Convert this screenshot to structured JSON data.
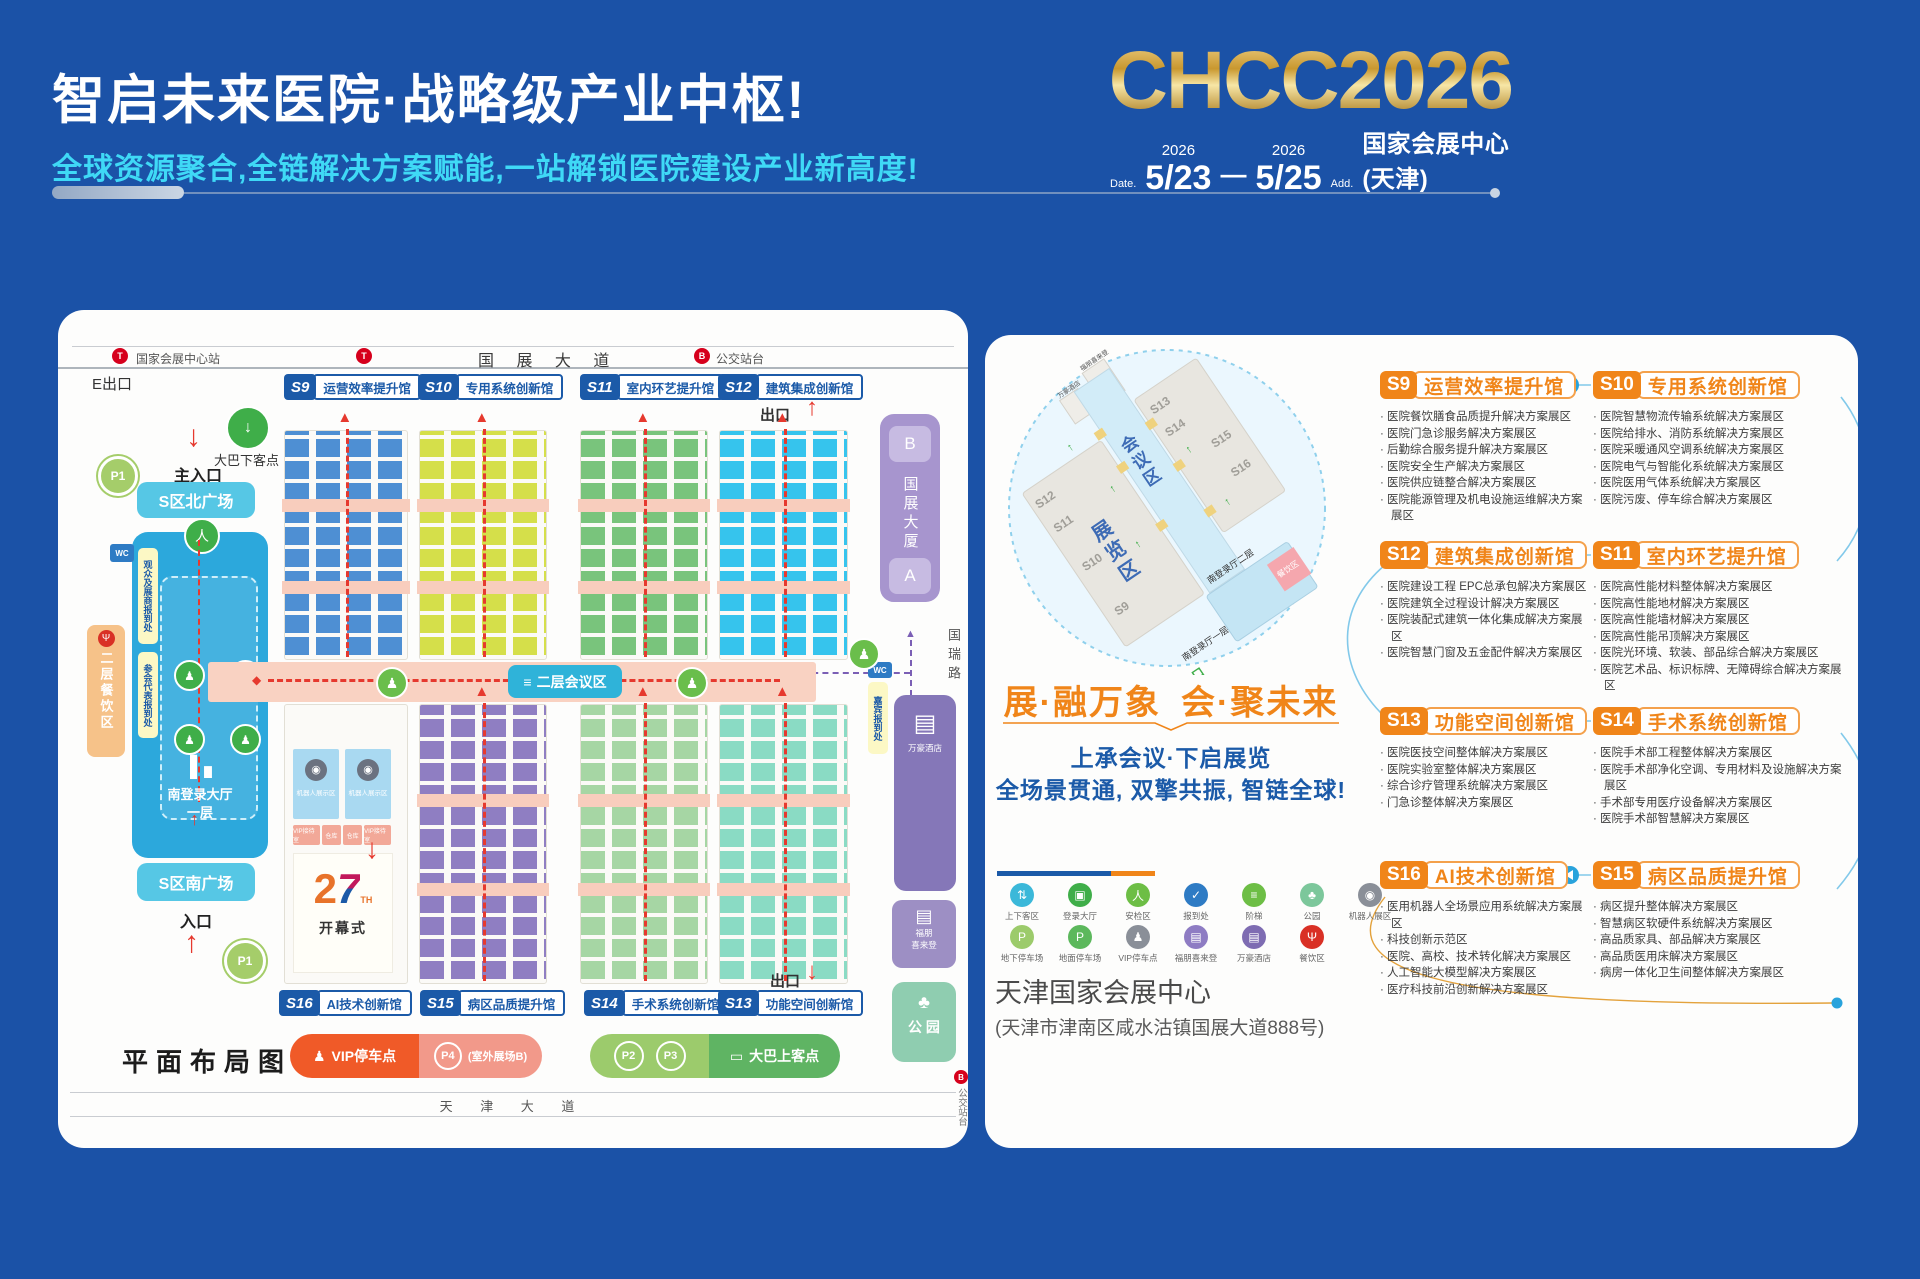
{
  "theme": {
    "page_bg": "#1B52A7",
    "orange": "#F08519",
    "blue": "#1B5AA8",
    "cyan": "#3FD9F6",
    "red": "#E6392E",
    "salmon": "#F8CDBD",
    "gold": "#D9A93C",
    "connector_blue": "#29A3DC"
  },
  "header": {
    "title": "智启未来医院·战略级产业中枢!",
    "subtitle": "全球资源聚合,全链解决方案赋能,一站解锁医院建设产业新高度!",
    "logo": "CHCC2026",
    "date_label": "Date.",
    "year_start": "2026",
    "date_start": "5/23",
    "dash": "—",
    "year_end": "2026",
    "date_end": "5/25",
    "addr_label": "Add.",
    "venue": "国家会展中心(天津)"
  },
  "map": {
    "top_road": {
      "station": "国家会展中心站",
      "bus": "公交站台",
      "name": "国 展 大 道",
      "exit_e": "E出口",
      "exit_f": "F出口",
      "exit_top": "出口"
    },
    "halls_top": [
      {
        "code": "S9",
        "name": "运营效率提升馆",
        "color": "#4E8FD3"
      },
      {
        "code": "S10",
        "name": "专用系统创新馆",
        "color": "#D5DF4A"
      },
      {
        "code": "S11",
        "name": "室内环艺提升馆",
        "color": "#79C47C"
      },
      {
        "code": "S12",
        "name": "建筑集成创新馆",
        "color": "#36C4ED"
      }
    ],
    "halls_bottom": [
      {
        "code": "S16",
        "name": "AI技术创新馆",
        "color": "#A9D9F1"
      },
      {
        "code": "S15",
        "name": "病区品质提升馆",
        "color": "#8F7EC2"
      },
      {
        "code": "S14",
        "name": "手术系统创新馆",
        "color": "#A6D6A4"
      },
      {
        "code": "S13",
        "name": "功能空间创新馆",
        "color": "#8ADBC4"
      }
    ],
    "left": {
      "p1": "P1",
      "bus_drop": "大巴下客点",
      "main_entrance": "主入口",
      "north_plaza": "S区北广场",
      "reg_visitor": "观众及展商报到处",
      "reg_delegate": "参会代表报到处",
      "wc": "WC",
      "dining": "二层餐饮区",
      "hall_line1": "南登录大厅",
      "hall_line2": "一层",
      "south_plaza": "S区南广场",
      "entrance": "入口",
      "p1b": "P1"
    },
    "center": {
      "conference": "二层会议区",
      "robot_zone": "机器人展示区",
      "vip_room": "VIP接待室",
      "storage": "仓库",
      "opening_num2": "2",
      "opening_num7": "7",
      "opening_th": "TH",
      "opening": "开幕式"
    },
    "right": {
      "tower_b": "B",
      "tower": "国展大厦",
      "tower_a": "A",
      "road": "国瑞路",
      "guest_reg": "嘉宾报到处",
      "hotel_marriott": "万豪酒店",
      "hotel_fp1": "福朋",
      "hotel_fp2": "喜来登",
      "park": "公 园",
      "exit_bottom": "出口",
      "bus_stop": "公交站台"
    },
    "bottom": {
      "vip_parking": "VIP停车点",
      "p4": "P4",
      "p4_note": "(室外展场B)",
      "p2": "P2",
      "p3": "P3",
      "bus_pickup": "大巴上客点",
      "plan_label": "平面布局图",
      "road_name": "天 津 大 道"
    }
  },
  "panel": {
    "circle": {
      "expo": "展览区",
      "conf": "会议区",
      "main_entrance": "主入口",
      "south_l2": "南登录厅二层",
      "south_l1": "南登录厅一层",
      "dining": "餐饮区",
      "hotel1": "万豪酒店",
      "hotel2": "福朋喜来登",
      "halls_left": [
        "S12",
        "S11",
        "S10",
        "S9"
      ],
      "halls_right": [
        "S13",
        "S14",
        "S15",
        "S16"
      ]
    },
    "slogan_left": "展·融万象",
    "slogan_right": "会·聚未来",
    "sub1": "上承会议·下启展览",
    "sub2": "全场景贯通, 双擎共振, 智链全球!",
    "legend_row1": [
      {
        "label": "上下客区",
        "color": "#3BB8D9",
        "glyph": "⇅",
        "name": "shuttle-zone-icon"
      },
      {
        "label": "登录大厅",
        "color": "#3FAE49",
        "glyph": "▣",
        "name": "login-hall-icon"
      },
      {
        "label": "安检区",
        "color": "#6DBE45",
        "glyph": "人",
        "name": "security-check-icon"
      },
      {
        "label": "报到处",
        "color": "#2E7BC4",
        "glyph": "✓",
        "name": "registration-icon"
      },
      {
        "label": "阶梯",
        "color": "#6DBE45",
        "glyph": "≡",
        "name": "stairs-icon"
      },
      {
        "label": "公园",
        "color": "#7CC79B",
        "glyph": "♣",
        "name": "park-icon"
      },
      {
        "label": "机器人展区",
        "color": "#8A8F98",
        "glyph": "◉",
        "name": "robot-zone-icon"
      }
    ],
    "legend_row2": [
      {
        "label": "地下停车场",
        "color": "#9CCB6B",
        "glyph": "P",
        "name": "underground-parking-icon"
      },
      {
        "label": "地面停车场",
        "color": "#5CB85C",
        "glyph": "P",
        "name": "ground-parking-icon"
      },
      {
        "label": "VIP停车点",
        "color": "#8A8F98",
        "glyph": "♟",
        "name": "vip-parking-icon"
      },
      {
        "label": "福朋喜来登",
        "color": "#8E7CC3",
        "glyph": "▤",
        "name": "fourpoints-hotel-icon"
      },
      {
        "label": "万豪酒店",
        "color": "#7E6CB2",
        "glyph": "▤",
        "name": "marriott-hotel-icon"
      },
      {
        "label": "餐饮区",
        "color": "#D93025",
        "glyph": "Ψ",
        "name": "dining-icon"
      }
    ],
    "venue": "天津国家会展中心",
    "venue_addr": "(天津市津南区咸水沽镇国展大道888号)"
  },
  "sections": [
    {
      "code": "S9",
      "name": "运营效率提升馆",
      "items": [
        "医院餐饮膳食品质提升解决方案展区",
        "医院门急诊服务解决方案展区",
        "后勤综合服务提升解决方案展区",
        "医院安全生产解决方案展区",
        "医院供应链整合解决方案展区",
        "医院能源管理及机电设施运维解决方案展区"
      ]
    },
    {
      "code": "S10",
      "name": "专用系统创新馆",
      "items": [
        "医院智慧物流传输系统解决方案展区",
        "医院给排水、消防系统解决方案展区",
        "医院采暖通风空调系统解决方案展区",
        "医院电气与智能化系统解决方案展区",
        "医院医用气体系统解决方案展区",
        "医院污废、停车综合解决方案展区"
      ]
    },
    {
      "code": "S12",
      "name": "建筑集成创新馆",
      "items": [
        "医院建设工程 EPC总承包解决方案展区",
        "医院建筑全过程设计解决方案展区",
        "医院装配式建筑一体化集成解决方案展区",
        "医院智慧门窗及五金配件解决方案展区"
      ]
    },
    {
      "code": "S11",
      "name": "室内环艺提升馆",
      "items": [
        "医院高性能材料整体解决方案展区",
        "医院高性能地材解决方案展区",
        "医院高性能墙材解决方案展区",
        "医院高性能吊顶解决方案展区",
        "医院光环境、软装、部品综合解决方案展区",
        "医院艺术品、标识标牌、无障碍综合解决方案展区"
      ]
    },
    {
      "code": "S13",
      "name": "功能空间创新馆",
      "items": [
        "医院医技空间整体解决方案展区",
        "医院实验室整体解决方案展区",
        "综合诊疗管理系统解决方案展区",
        "门急诊整体解决方案展区"
      ]
    },
    {
      "code": "S14",
      "name": "手术系统创新馆",
      "items": [
        "医院手术部工程整体解决方案展区",
        "医院手术部净化空调、专用材料及设施解决方案展区",
        "手术部专用医疗设备解决方案展区",
        "医院手术部智慧解决方案展区"
      ]
    },
    {
      "code": "S16",
      "name": "AI技术创新馆",
      "items": [
        "医用机器人全场景应用系统解决方案展区",
        "科技创新示范区",
        "医院、高校、技术转化解决方案展区",
        "人工智能大模型解决方案展区",
        "医疗科技前沿创新解决方案展区"
      ]
    },
    {
      "code": "S15",
      "name": "病区品质提升馆",
      "items": [
        "病区提升整体解决方案展区",
        "智慧病区软硬件系统解决方案展区",
        "高品质家具、部品解决方案展区",
        "高品质医用床解决方案展区",
        "病房一体化卫生间整体解决方案展区"
      ]
    }
  ]
}
